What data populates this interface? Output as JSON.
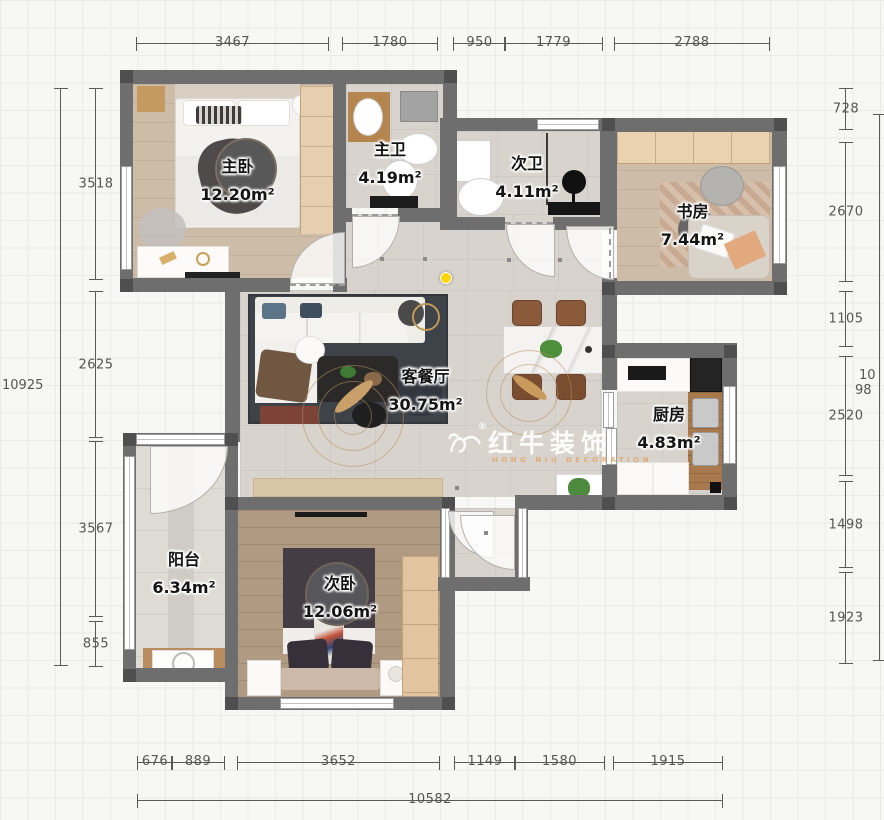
{
  "rooms": [
    {
      "id": "master-bedroom",
      "name": "主卧",
      "area": "12.20m²"
    },
    {
      "id": "master-bath",
      "name": "主卫",
      "area": "4.19m²"
    },
    {
      "id": "second-bath",
      "name": "次卫",
      "area": "4.11m²"
    },
    {
      "id": "study",
      "name": "书房",
      "area": "7.44m²"
    },
    {
      "id": "living-dining",
      "name": "客餐厅",
      "area": "30.75m²"
    },
    {
      "id": "kitchen",
      "name": "厨房",
      "area": "4.83m²"
    },
    {
      "id": "balcony",
      "name": "阳台",
      "area": "6.34m²"
    },
    {
      "id": "second-bedroom",
      "name": "次卧",
      "area": "12.06m²"
    }
  ],
  "dimensions": {
    "top": [
      "3467",
      "1780",
      "950",
      "1779",
      "2788"
    ],
    "left_overall": "10925",
    "left": [
      "3518",
      "2625",
      "3567",
      "855"
    ],
    "right": [
      "728",
      "2670",
      "1105",
      "2520",
      "1498",
      "1923"
    ],
    "right_overall_clipped": [
      "10",
      "98"
    ],
    "bottom": [
      "676",
      "889",
      "3652",
      "1149",
      "1580",
      "1915"
    ],
    "bottom_overall": "10582"
  },
  "watermark": {
    "brand": "红牛装饰",
    "subtitle": "HONG NIU DECORATION",
    "mark": "®"
  }
}
